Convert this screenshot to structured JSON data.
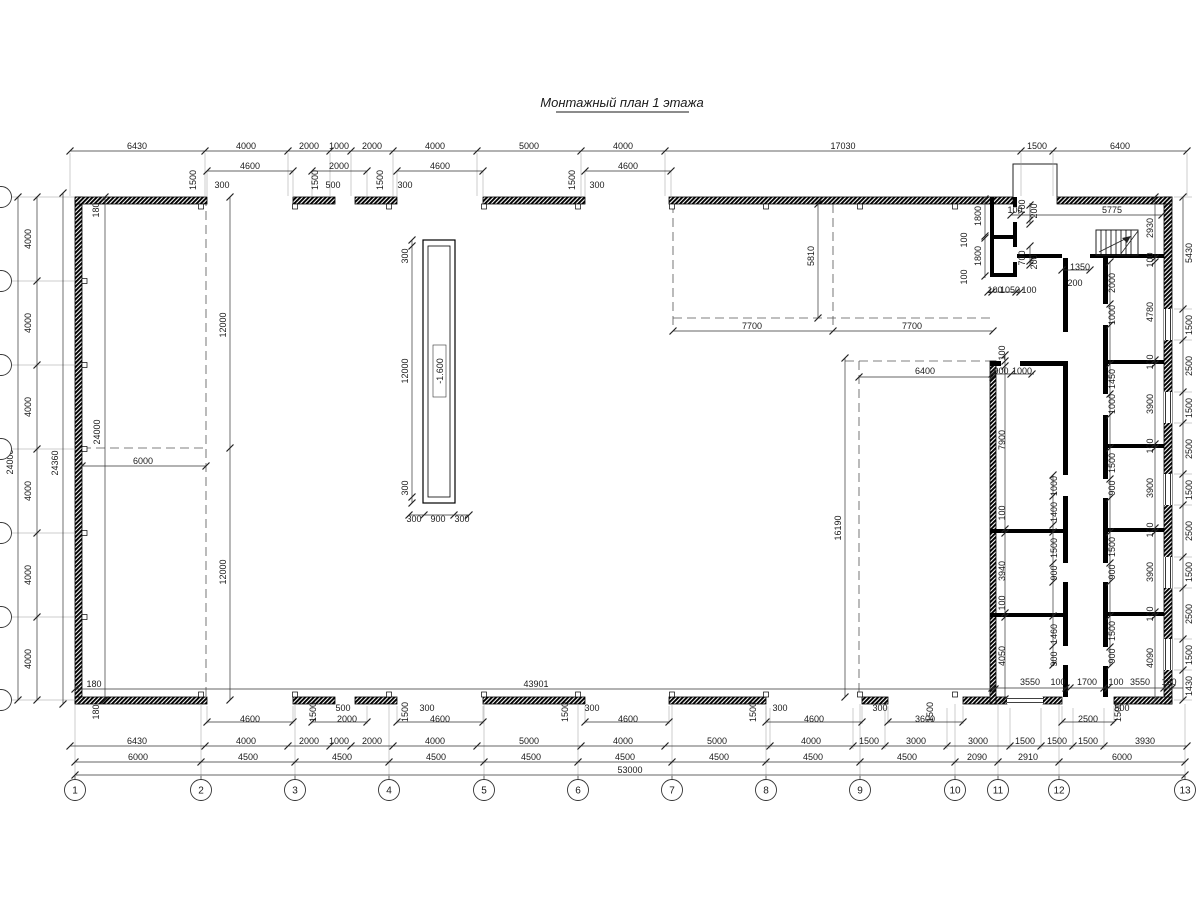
{
  "title": "Монтажный план 1 этажа",
  "pit_label": "-1.600",
  "grid_bubbles": [
    {
      "n": "1",
      "x": 75
    },
    {
      "n": "2",
      "x": 201
    },
    {
      "n": "3",
      "x": 295
    },
    {
      "n": "4",
      "x": 389
    },
    {
      "n": "5",
      "x": 484
    },
    {
      "n": "6",
      "x": 578
    },
    {
      "n": "7",
      "x": 672
    },
    {
      "n": "8",
      "x": 766
    },
    {
      "n": "9",
      "x": 860
    },
    {
      "n": "10",
      "x": 955
    },
    {
      "n": "11",
      "x": 998
    },
    {
      "n": "12",
      "x": 1059
    },
    {
      "n": "13",
      "x": 1185
    }
  ],
  "dim_labels": [
    {
      "t": "6430",
      "x": 137,
      "y": 146
    },
    {
      "t": "4000",
      "x": 246,
      "y": 146
    },
    {
      "t": "2000",
      "x": 309,
      "y": 146
    },
    {
      "t": "1000",
      "x": 339,
      "y": 146
    },
    {
      "t": "2000",
      "x": 372,
      "y": 146
    },
    {
      "t": "4000",
      "x": 435,
      "y": 146
    },
    {
      "t": "5000",
      "x": 529,
      "y": 146
    },
    {
      "t": "4000",
      "x": 623,
      "y": 146
    },
    {
      "t": "17030",
      "x": 843,
      "y": 146
    },
    {
      "t": "1500",
      "x": 1037,
      "y": 146
    },
    {
      "t": "6400",
      "x": 1120,
      "y": 146
    },
    {
      "t": "4600",
      "x": 250,
      "y": 166
    },
    {
      "t": "2000",
      "x": 339,
      "y": 166
    },
    {
      "t": "4600",
      "x": 440,
      "y": 166
    },
    {
      "t": "4600",
      "x": 628,
      "y": 166
    },
    {
      "t": "1500",
      "x": 193,
      "y": 180,
      "r": 1
    },
    {
      "t": "1500",
      "x": 315,
      "y": 180,
      "r": 1
    },
    {
      "t": "1500",
      "x": 380,
      "y": 180,
      "r": 1
    },
    {
      "t": "1500",
      "x": 572,
      "y": 180,
      "r": 1
    },
    {
      "t": "300",
      "x": 222,
      "y": 185
    },
    {
      "t": "500",
      "x": 333,
      "y": 185
    },
    {
      "t": "300",
      "x": 405,
      "y": 185
    },
    {
      "t": "300",
      "x": 597,
      "y": 185
    },
    {
      "t": "1800",
      "x": 978,
      "y": 216,
      "r": 1
    },
    {
      "t": "100",
      "x": 964,
      "y": 240,
      "r": 1
    },
    {
      "t": "1800",
      "x": 978,
      "y": 256,
      "r": 1
    },
    {
      "t": "100",
      "x": 964,
      "y": 277,
      "r": 1
    },
    {
      "t": "700",
      "x": 1022,
      "y": 207,
      "r": 1
    },
    {
      "t": "200",
      "x": 1034,
      "y": 211,
      "r": 1
    },
    {
      "t": "700",
      "x": 1022,
      "y": 258,
      "r": 1
    },
    {
      "t": "200",
      "x": 1034,
      "y": 262,
      "r": 1
    },
    {
      "t": "100",
      "x": 995,
      "y": 290
    },
    {
      "t": "1050",
      "x": 1010,
      "y": 290
    },
    {
      "t": "100",
      "x": 1029,
      "y": 290
    },
    {
      "t": "100",
      "x": 1015,
      "y": 210
    },
    {
      "t": "5775",
      "x": 1112,
      "y": 210
    },
    {
      "t": "1350",
      "x": 1080,
      "y": 267
    },
    {
      "t": "200",
      "x": 1075,
      "y": 283
    },
    {
      "t": "2000",
      "x": 1112,
      "y": 283,
      "r": 1
    },
    {
      "t": "1000",
      "x": 1112,
      "y": 315,
      "r": 1
    },
    {
      "t": "1450",
      "x": 1112,
      "y": 379,
      "r": 1
    },
    {
      "t": "1000",
      "x": 1112,
      "y": 404,
      "r": 1
    },
    {
      "t": "1500",
      "x": 1112,
      "y": 463,
      "r": 1
    },
    {
      "t": "900",
      "x": 1112,
      "y": 488,
      "r": 1
    },
    {
      "t": "1500",
      "x": 1112,
      "y": 547,
      "r": 1
    },
    {
      "t": "900",
      "x": 1112,
      "y": 572,
      "r": 1
    },
    {
      "t": "1500",
      "x": 1112,
      "y": 631,
      "r": 1
    },
    {
      "t": "900",
      "x": 1112,
      "y": 656,
      "r": 1
    },
    {
      "t": "2930",
      "x": 1150,
      "y": 228,
      "r": 1
    },
    {
      "t": "100",
      "x": 1150,
      "y": 260,
      "r": 1
    },
    {
      "t": "4780",
      "x": 1150,
      "y": 312,
      "r": 1
    },
    {
      "t": "100",
      "x": 1150,
      "y": 362,
      "r": 1
    },
    {
      "t": "3900",
      "x": 1150,
      "y": 404,
      "r": 1
    },
    {
      "t": "100",
      "x": 1150,
      "y": 446,
      "r": 1
    },
    {
      "t": "3900",
      "x": 1150,
      "y": 488,
      "r": 1
    },
    {
      "t": "100",
      "x": 1150,
      "y": 530,
      "r": 1
    },
    {
      "t": "3900",
      "x": 1150,
      "y": 572,
      "r": 1
    },
    {
      "t": "100",
      "x": 1150,
      "y": 614,
      "r": 1
    },
    {
      "t": "4090",
      "x": 1150,
      "y": 658,
      "r": 1
    },
    {
      "t": "5430",
      "x": 1189,
      "y": 253,
      "r": 1
    },
    {
      "t": "1500",
      "x": 1189,
      "y": 325,
      "r": 1
    },
    {
      "t": "2500",
      "x": 1189,
      "y": 366,
      "r": 1
    },
    {
      "t": "1500",
      "x": 1189,
      "y": 408,
      "r": 1
    },
    {
      "t": "2500",
      "x": 1189,
      "y": 449,
      "r": 1
    },
    {
      "t": "1500",
      "x": 1189,
      "y": 490,
      "r": 1
    },
    {
      "t": "2500",
      "x": 1189,
      "y": 531,
      "r": 1
    },
    {
      "t": "1500",
      "x": 1189,
      "y": 572,
      "r": 1
    },
    {
      "t": "2500",
      "x": 1189,
      "y": 614,
      "r": 1
    },
    {
      "t": "1500",
      "x": 1189,
      "y": 655,
      "r": 1
    },
    {
      "t": "1430",
      "x": 1189,
      "y": 686,
      "r": 1
    },
    {
      "t": "100",
      "x": 1002,
      "y": 353,
      "r": 1
    },
    {
      "t": "7900",
      "x": 1002,
      "y": 440,
      "r": 1
    },
    {
      "t": "100",
      "x": 1002,
      "y": 513,
      "r": 1
    },
    {
      "t": "3940",
      "x": 1002,
      "y": 571,
      "r": 1
    },
    {
      "t": "100",
      "x": 1002,
      "y": 603,
      "r": 1
    },
    {
      "t": "4050",
      "x": 1002,
      "y": 656,
      "r": 1
    },
    {
      "t": "900",
      "x": 1001,
      "y": 371
    },
    {
      "t": "1000",
      "x": 1022,
      "y": 371
    },
    {
      "t": "1000",
      "x": 1054,
      "y": 486,
      "r": 1
    },
    {
      "t": "1400",
      "x": 1054,
      "y": 512,
      "r": 1
    },
    {
      "t": "1500",
      "x": 1054,
      "y": 548,
      "r": 1
    },
    {
      "t": "900",
      "x": 1054,
      "y": 573,
      "r": 1
    },
    {
      "t": "1460",
      "x": 1054,
      "y": 634,
      "r": 1
    },
    {
      "t": "900",
      "x": 1054,
      "y": 659,
      "r": 1
    },
    {
      "t": "3550",
      "x": 1030,
      "y": 682
    },
    {
      "t": "100",
      "x": 1058,
      "y": 682
    },
    {
      "t": "1700",
      "x": 1087,
      "y": 682
    },
    {
      "t": "100",
      "x": 1116,
      "y": 682
    },
    {
      "t": "3550",
      "x": 1140,
      "y": 682
    },
    {
      "t": "180",
      "x": 1169,
      "y": 682
    },
    {
      "t": "5810",
      "x": 811,
      "y": 256,
      "r": 1
    },
    {
      "t": "7700",
      "x": 752,
      "y": 326
    },
    {
      "t": "7700",
      "x": 912,
      "y": 326
    },
    {
      "t": "16190",
      "x": 838,
      "y": 528,
      "r": 1
    },
    {
      "t": "6400",
      "x": 925,
      "y": 371
    },
    {
      "t": "12000",
      "x": 223,
      "y": 325,
      "r": 1
    },
    {
      "t": "12000",
      "x": 223,
      "y": 572,
      "r": 1
    },
    {
      "t": "6000",
      "x": 143,
      "y": 461
    },
    {
      "t": "24000",
      "x": 97,
      "y": 432,
      "r": 1
    },
    {
      "t": "300",
      "x": 405,
      "y": 256,
      "r": 1
    },
    {
      "t": "12000",
      "x": 405,
      "y": 371,
      "r": 1
    },
    {
      "t": "300",
      "x": 405,
      "y": 488,
      "r": 1
    },
    {
      "t": "300",
      "x": 414,
      "y": 519
    },
    {
      "t": "900",
      "x": 438,
      "y": 519
    },
    {
      "t": "300",
      "x": 462,
      "y": 519
    },
    {
      "t": "24000",
      "x": 10,
      "y": 462,
      "r": 1
    },
    {
      "t": "24360",
      "x": 55,
      "y": 463,
      "r": 1
    },
    {
      "t": "180",
      "x": 96,
      "y": 210,
      "r": 1
    },
    {
      "t": "180",
      "x": 96,
      "y": 712,
      "r": 1
    },
    {
      "t": "180",
      "x": 94,
      "y": 684
    },
    {
      "t": "4000",
      "x": 28,
      "y": 239,
      "r": 1
    },
    {
      "t": "4000",
      "x": 28,
      "y": 323,
      "r": 1
    },
    {
      "t": "4000",
      "x": 28,
      "y": 407,
      "r": 1
    },
    {
      "t": "4000",
      "x": 28,
      "y": 491,
      "r": 1
    },
    {
      "t": "4000",
      "x": 28,
      "y": 575,
      "r": 1
    },
    {
      "t": "4000",
      "x": 28,
      "y": 659,
      "r": 1
    },
    {
      "t": "43901",
      "x": 536,
      "y": 684
    },
    {
      "t": "1500",
      "x": 313,
      "y": 712,
      "r": 1
    },
    {
      "t": "1500",
      "x": 405,
      "y": 712,
      "r": 1
    },
    {
      "t": "1500",
      "x": 565,
      "y": 712,
      "r": 1
    },
    {
      "t": "1500",
      "x": 753,
      "y": 712,
      "r": 1
    },
    {
      "t": "1500",
      "x": 930,
      "y": 712,
      "r": 1
    },
    {
      "t": "1500",
      "x": 1118,
      "y": 712,
      "r": 1
    },
    {
      "t": "300",
      "x": 427,
      "y": 708
    },
    {
      "t": "300",
      "x": 592,
      "y": 708
    },
    {
      "t": "300",
      "x": 780,
      "y": 708
    },
    {
      "t": "300",
      "x": 880,
      "y": 708
    },
    {
      "t": "500",
      "x": 343,
      "y": 708
    },
    {
      "t": "500",
      "x": 1122,
      "y": 708
    },
    {
      "t": "4600",
      "x": 250,
      "y": 719
    },
    {
      "t": "2000",
      "x": 347,
      "y": 719
    },
    {
      "t": "4600",
      "x": 440,
      "y": 719
    },
    {
      "t": "4600",
      "x": 628,
      "y": 719
    },
    {
      "t": "4600",
      "x": 814,
      "y": 719
    },
    {
      "t": "3600",
      "x": 925,
      "y": 719
    },
    {
      "t": "2500",
      "x": 1088,
      "y": 719
    },
    {
      "t": "6430",
      "x": 137,
      "y": 741
    },
    {
      "t": "4000",
      "x": 246,
      "y": 741
    },
    {
      "t": "2000",
      "x": 309,
      "y": 741
    },
    {
      "t": "1000",
      "x": 339,
      "y": 741
    },
    {
      "t": "2000",
      "x": 372,
      "y": 741
    },
    {
      "t": "4000",
      "x": 435,
      "y": 741
    },
    {
      "t": "5000",
      "x": 529,
      "y": 741
    },
    {
      "t": "4000",
      "x": 623,
      "y": 741
    },
    {
      "t": "5000",
      "x": 717,
      "y": 741
    },
    {
      "t": "4000",
      "x": 811,
      "y": 741
    },
    {
      "t": "1500",
      "x": 869,
      "y": 741
    },
    {
      "t": "3000",
      "x": 916,
      "y": 741
    },
    {
      "t": "3000",
      "x": 978,
      "y": 741
    },
    {
      "t": "1500",
      "x": 1025,
      "y": 741
    },
    {
      "t": "1500",
      "x": 1057,
      "y": 741
    },
    {
      "t": "1500",
      "x": 1088,
      "y": 741
    },
    {
      "t": "3930",
      "x": 1145,
      "y": 741
    },
    {
      "t": "6000",
      "x": 138,
      "y": 757
    },
    {
      "t": "4500",
      "x": 248,
      "y": 757
    },
    {
      "t": "4500",
      "x": 342,
      "y": 757
    },
    {
      "t": "4500",
      "x": 436,
      "y": 757
    },
    {
      "t": "4500",
      "x": 531,
      "y": 757
    },
    {
      "t": "4500",
      "x": 625,
      "y": 757
    },
    {
      "t": "4500",
      "x": 719,
      "y": 757
    },
    {
      "t": "4500",
      "x": 813,
      "y": 757
    },
    {
      "t": "4500",
      "x": 907,
      "y": 757
    },
    {
      "t": "2090",
      "x": 977,
      "y": 757
    },
    {
      "t": "2910",
      "x": 1028,
      "y": 757
    },
    {
      "t": "6000",
      "x": 1122,
      "y": 757
    },
    {
      "t": "53000",
      "x": 630,
      "y": 770
    }
  ]
}
